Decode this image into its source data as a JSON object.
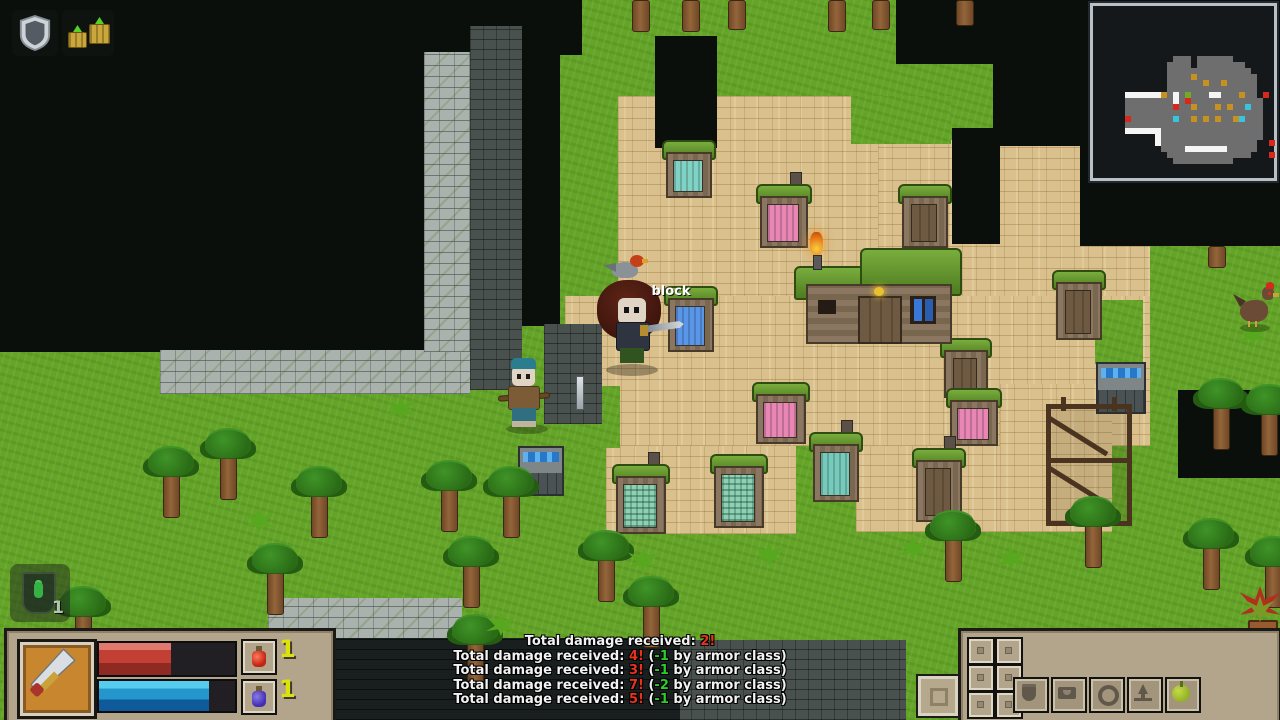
{
  "world": {
    "floating_text": "block"
  },
  "buffs": {
    "items": [
      {
        "icon": "shield-buff-icon"
      },
      {
        "icon": "regrowth-buff-icon"
      }
    ]
  },
  "minimap": {
    "bg": "#14181a",
    "border": "#b7c0c7",
    "palette": {
      "g": "#6e6e6e",
      "w": "#f5f5f5",
      "o": "#c79122",
      "r": "#d8281c",
      "c": "#38c4de",
      "e": "#73aa24"
    },
    "pixels": [
      ".............ggg.gggggg.......",
      "............gggg.gggggggg.....",
      "............gggggggggggggg....",
      "............ggggogggggggggg...",
      "............ggggggoggoggggg...",
      "............ggggggggggggggg...",
      ".....wwwwwwogwgegggwwgggogg.r.",
      ".....ggggggggwgrgggggggggggg..",
      ".....ggggggggrggogggogoggcgg..",
      ".....ggggggggggggggggggggggg..",
      ".....rgggggggcggogogoggocggg..",
      ".....ggggggggggggggggggggggg..",
      ".....wwwwwwggggggggggggggggg..",
      "..........wggggggggggggggggg..",
      "..........wgggggggggggggggg..r",
      "...........ggggwwwwwwwggggg...",
      "............gggggggggggggg...r",
      ".............gggggggggg......."
    ]
  },
  "combat_log": {
    "lines": [
      {
        "pre": "Total damage received: ",
        "dmg": "2!",
        "mid": "",
        "mod": "",
        "post": ""
      },
      {
        "pre": "Total damage received: ",
        "dmg": "4!",
        "mid": " (",
        "mod": "-1",
        "post": " by armor class)"
      },
      {
        "pre": "Total damage received: ",
        "dmg": "3!",
        "mid": " (",
        "mod": "-1",
        "post": " by armor class)"
      },
      {
        "pre": "Total damage received: ",
        "dmg": "7!",
        "mid": " (",
        "mod": "-2",
        "post": " by armor class)"
      },
      {
        "pre": "Total damage received: ",
        "dmg": "5!",
        "mid": " (",
        "mod": "-1",
        "post": " by armor class)"
      }
    ]
  },
  "hud": {
    "health": {
      "percent": 53,
      "color": "#c23f33"
    },
    "mana": {
      "percent": 81,
      "color": "#2596cc"
    },
    "weapon": "sword",
    "potions": [
      {
        "name": "health-potion",
        "count": "1"
      },
      {
        "name": "mana-potion",
        "count": "1"
      }
    ],
    "loot_toast": {
      "count": "1"
    }
  },
  "hotbar": {
    "buttons": [
      {
        "icon": "crest-icon"
      },
      {
        "icon": "satchel-icon"
      },
      {
        "icon": "ring-icon"
      },
      {
        "icon": "ascend-icon"
      },
      {
        "icon": "food-icon"
      }
    ],
    "held_item": "rock"
  },
  "colors": {
    "grass": "#64a427",
    "sand": "#d9c08c",
    "dark": "#0a0f0c",
    "panel": "#b3a58b",
    "count_yellow": "#dce20a",
    "log_red": "#e8321e",
    "log_green": "#2ecb2e",
    "health_red": "#c23f33",
    "mana_blue": "#2596cc",
    "roof_green": "#5e9130"
  }
}
